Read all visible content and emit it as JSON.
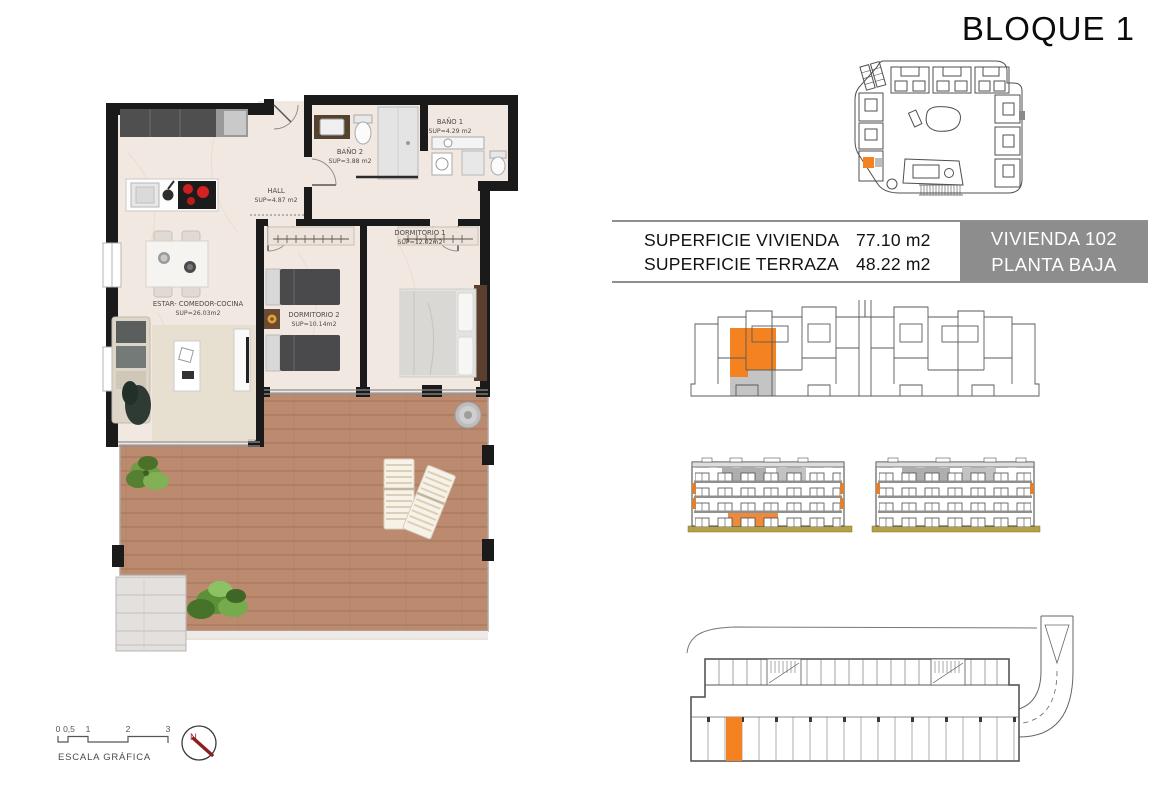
{
  "header": {
    "title": "BLOQUE 1"
  },
  "info_table": {
    "rows": [
      {
        "label": "SUPERFICIE VIVIENDA",
        "value": "77.10 m2"
      },
      {
        "label": "SUPERFICIE TERRAZA",
        "value": "48.22 m2"
      }
    ],
    "unit_box": {
      "line1": "VIVIENDA 102",
      "line2": "PLANTA BAJA"
    }
  },
  "floor_plan": {
    "rooms": {
      "bano1": {
        "name": "BAÑO 1",
        "area": "SUP=4.29 m2"
      },
      "bano2": {
        "name": "BAÑO 2",
        "area": "SUP=3.88 m2"
      },
      "hall": {
        "name": "HALL",
        "area": "SUP=4.87 m2"
      },
      "dormitorio1": {
        "name": "DORMITORIO 1",
        "area": "SUP=12.02m2"
      },
      "dormitorio2": {
        "name": "DORMITORIO 2",
        "area": "SUP=10.14m2"
      },
      "estar": {
        "name": "ESTAR- COMEDOR-COCINA",
        "area": "SUP=26.03m2"
      }
    }
  },
  "scale_bar": {
    "ticks": [
      "0",
      "0,5",
      "1",
      "2",
      "3"
    ],
    "label": "ESCALA GRÁFICA"
  },
  "compass": {
    "north": "N"
  },
  "colors": {
    "highlight_orange": "#f58220",
    "terrace_key_gray": "#c4c4c4",
    "unit_box_gray": "#8d8d8d",
    "terrace_wood": "#bb8a6f",
    "ground_olive": "#b3a04a"
  }
}
